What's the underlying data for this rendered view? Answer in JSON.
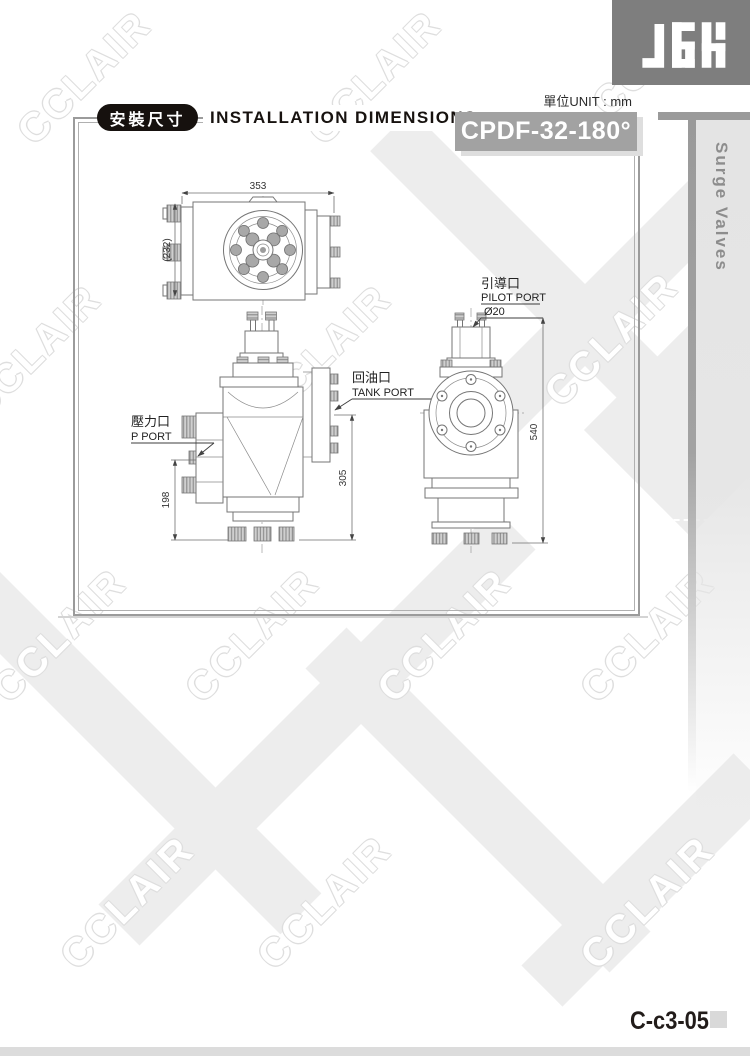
{
  "page": {
    "watermark_text": "CCLAIR",
    "unit_label": "單位UNIT : mm",
    "page_code": "C-c3-05"
  },
  "header": {
    "logo_text": "JGH",
    "section_badge": "安裝尺寸",
    "section_title": "INSTALLATION DIMENSIONS",
    "model_code": "CPDF-32-180°"
  },
  "side_tab": {
    "label": "Surge Valves"
  },
  "drawing": {
    "top_view": {
      "dim_width": "353",
      "dim_height": "(232)"
    },
    "side_view": {
      "p_port_zh": "壓力口",
      "p_port_en": "P PORT",
      "tank_port_zh": "回油口",
      "tank_port_en": "TANK PORT",
      "dim_p_port_height": "198",
      "dim_tank_height": "305"
    },
    "front_view": {
      "pilot_port_zh": "引導口",
      "pilot_port_en": "PILOT PORT",
      "pilot_dia": "Ø20",
      "dim_total_height": "540"
    }
  }
}
